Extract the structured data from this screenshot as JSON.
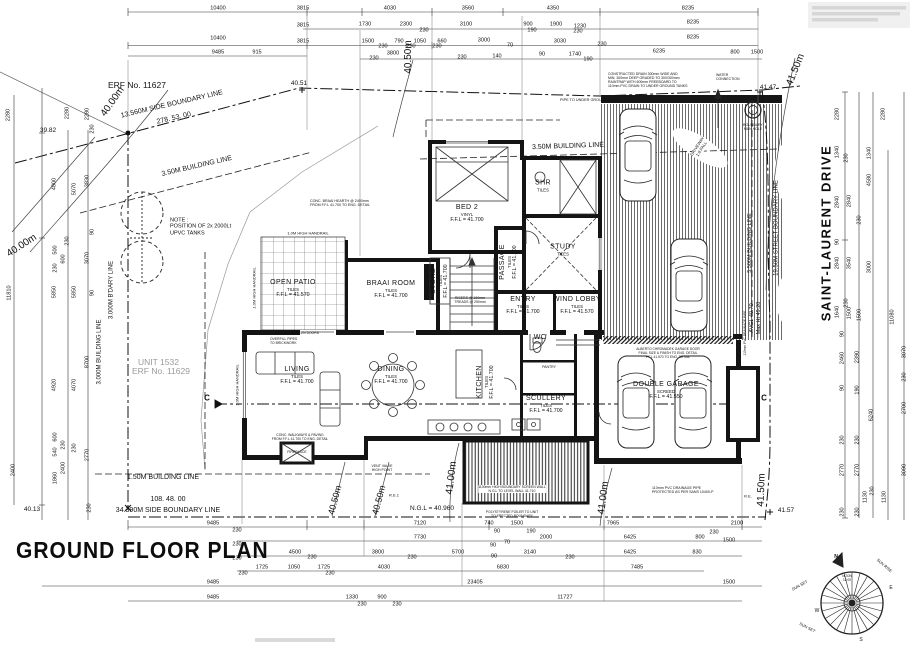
{
  "title": "GROUND FLOOR PLAN",
  "site": {
    "erf_label": "ERF No. 11627",
    "unit_label": "UNIT 1532",
    "unit_erf_label": "ERF No. 11629",
    "street_name": "SAINT-LAURENT DRIVE"
  },
  "rooms": [
    {
      "name": "OPEN PATIO",
      "finish": "TILES",
      "ffl": "F.F.L = 41.570",
      "x": 293,
      "y": 289
    },
    {
      "name": "BRAAI ROOM",
      "finish": "TILES",
      "ffl": "F.F.L = 41.700",
      "x": 391,
      "y": 290
    },
    {
      "name": "BED 2",
      "finish": "VINYL",
      "ffl": "F.F.L = 41.700",
      "x": 467,
      "y": 214
    },
    {
      "name": "SHR",
      "finish": "TILES",
      "ffl": "",
      "x": 543,
      "y": 186
    },
    {
      "name": "STUDY",
      "finish": "TILES",
      "ffl": "",
      "x": 563,
      "y": 250
    },
    {
      "name": "PASSAGE",
      "finish": "TILES",
      "ffl": "F.F.L = 41.700",
      "x": 509,
      "y": 262,
      "r": -90
    },
    {
      "name": "STORE",
      "finish": "TILES",
      "ffl": "F.F.L = 41.700",
      "x": 440,
      "y": 281,
      "r": -90
    },
    {
      "name": "ENTRY",
      "finish": "TILES",
      "ffl": "F.F.L = 41.700",
      "x": 523,
      "y": 306
    },
    {
      "name": "WIND LOBBY",
      "finish": "TILES",
      "ffl": "F.F.L = 41.570",
      "x": 577,
      "y": 306
    },
    {
      "name": "LIVING",
      "finish": "TILES",
      "ffl": "F.F.L = 41.700",
      "x": 297,
      "y": 376
    },
    {
      "name": "DINING",
      "finish": "TILES",
      "ffl": "F.F.L = 41.700",
      "x": 391,
      "y": 376
    },
    {
      "name": "KITCHEN",
      "finish": "TILES",
      "ffl": "F.F.L = 41.700",
      "x": 486,
      "y": 382,
      "r": -90
    },
    {
      "name": "SCULLERY",
      "finish": "TILES",
      "ffl": "F.F.L = 41.700",
      "x": 546,
      "y": 405
    },
    {
      "name": "WC",
      "finish": "",
      "ffl": "",
      "x": 540,
      "y": 338
    },
    {
      "name": "DOUBLE GARAGE",
      "finish": "SCREED",
      "ffl": "F.F.L = 41.550",
      "x": 666,
      "y": 391
    }
  ],
  "boundary_labels": [
    {
      "t": "13.560M SIDE BOUNDARY LINE",
      "x": 172,
      "y": 105,
      "r": -13,
      "size": 7,
      "n": "side-boundary-label"
    },
    {
      "t": "278.  53.  00",
      "x": 174,
      "y": 119,
      "r": -13,
      "size": 7,
      "n": "bearing-label"
    },
    {
      "t": "3.50M BUILDING LINE",
      "x": 197,
      "y": 167,
      "r": -13,
      "size": 7,
      "n": "building-line-label"
    },
    {
      "t": "3.50M BUILDING LINE",
      "x": 568,
      "y": 147,
      "r": -2,
      "size": 7,
      "n": "building-line-label"
    },
    {
      "t": "1.50M BUILDING LINE",
      "x": 163,
      "y": 478,
      "r": 0,
      "size": 7,
      "n": "building-line-label"
    },
    {
      "t": "108.  48.  00",
      "x": 168,
      "y": 500,
      "r": 0,
      "size": 7,
      "n": "bearing-label"
    },
    {
      "t": "34.390M SIDE BOUNDARY LINE",
      "x": 168,
      "y": 511,
      "r": 0,
      "size": 7,
      "n": "side-boundary-label"
    },
    {
      "t": "19.50M STREET BOUNDARY LINE",
      "x": 777,
      "y": 228,
      "r": -90,
      "size": 6,
      "n": "street-boundary-label"
    },
    {
      "t": "5.500M BUILDING LINE",
      "x": 750,
      "y": 243,
      "r": -90,
      "size": 5.5,
      "n": "building-line-label"
    },
    {
      "t": "3.000M B'DARY LINE",
      "x": 112,
      "y": 290,
      "r": -90,
      "size": 6,
      "n": "boundary-label"
    },
    {
      "t": "3.000M BUILDING LINE",
      "x": 100,
      "y": 352,
      "r": -90,
      "size": 6,
      "n": "building-line-label"
    },
    {
      "t": "C",
      "x": 207,
      "y": 398,
      "r": 0,
      "size": 8,
      "bold": true,
      "n": "section-marker"
    },
    {
      "t": "C",
      "x": 764,
      "y": 398,
      "r": 0,
      "size": 8,
      "bold": true,
      "n": "section-marker"
    }
  ],
  "levels": [
    {
      "t": "40.00m",
      "x": 113,
      "y": 102,
      "r": -55,
      "size": 10
    },
    {
      "t": "40.00m",
      "x": 22,
      "y": 246,
      "r": -33,
      "size": 10
    },
    {
      "t": "40.50m",
      "x": 409,
      "y": 57,
      "r": -90,
      "size": 10
    },
    {
      "t": "40.50m",
      "x": 335,
      "y": 500,
      "r": -75,
      "size": 9
    },
    {
      "t": "40.50m",
      "x": 379,
      "y": 500,
      "r": -75,
      "size": 9
    },
    {
      "t": "41.00m",
      "x": 452,
      "y": 478,
      "r": -83,
      "size": 10
    },
    {
      "t": "41.00m",
      "x": 604,
      "y": 498,
      "r": -83,
      "size": 10
    },
    {
      "t": "41.50m",
      "x": 796,
      "y": 70,
      "r": -68,
      "size": 10
    },
    {
      "t": "41.50m",
      "x": 762,
      "y": 490,
      "r": -88,
      "size": 10
    },
    {
      "t": "39.82",
      "x": 48,
      "y": 131,
      "size": 6.5
    },
    {
      "t": "40.51",
      "x": 299,
      "y": 84,
      "size": 6.5
    },
    {
      "t": "41.47",
      "x": 768,
      "y": 88,
      "size": 6.5
    },
    {
      "t": "41.57",
      "x": 786,
      "y": 511,
      "size": 6.5
    },
    {
      "t": "40.13",
      "x": 32,
      "y": 510,
      "size": 6.5
    },
    {
      "t": "N.G.L = 40.960",
      "x": 432,
      "y": 509,
      "size": 6.5
    },
    {
      "t": "AVGL 40.70",
      "x": 752,
      "y": 318,
      "r": -90,
      "size": 5.5
    },
    {
      "t": "Max Ht 49.20",
      "x": 759,
      "y": 318,
      "r": -90,
      "size": 5.5
    }
  ],
  "dims_top": [
    [
      "10400",
      218,
      9
    ],
    [
      "3815",
      303,
      9
    ],
    [
      "4030",
      390,
      9
    ],
    [
      "3560",
      468,
      9
    ],
    [
      "4350",
      553,
      9
    ],
    [
      "8235",
      688,
      9
    ],
    [
      "3815",
      303,
      26
    ],
    [
      "1730",
      365,
      25
    ],
    [
      "2300",
      406,
      25
    ],
    [
      "230",
      424,
      31
    ],
    [
      "3100",
      466,
      25
    ],
    [
      "900",
      528,
      25
    ],
    [
      "1900",
      556,
      25
    ],
    [
      "1230",
      580,
      27
    ],
    [
      "190",
      532,
      31
    ],
    [
      "230",
      578,
      32
    ],
    [
      "8235",
      693,
      23
    ],
    [
      "10400",
      218,
      39
    ],
    [
      "3815",
      303,
      42
    ],
    [
      "1500",
      368,
      42
    ],
    [
      "790",
      399,
      42
    ],
    [
      "1050",
      420,
      42
    ],
    [
      "660",
      442,
      42
    ],
    [
      "230",
      383,
      47
    ],
    [
      "230",
      411,
      47
    ],
    [
      "230",
      437,
      47
    ],
    [
      "3000",
      484,
      41
    ],
    [
      "70",
      510,
      46
    ],
    [
      "3030",
      560,
      42
    ],
    [
      "230",
      602,
      45
    ],
    [
      "8235",
      693,
      38
    ],
    [
      "9485",
      218,
      53
    ],
    [
      "915",
      257,
      53
    ],
    [
      "3800",
      393,
      54
    ],
    [
      "230",
      374,
      59
    ],
    [
      "140",
      497,
      57
    ],
    [
      "90",
      542,
      55
    ],
    [
      "1740",
      575,
      55
    ],
    [
      "190",
      588,
      60
    ],
    [
      "230",
      462,
      58
    ],
    [
      "6235",
      659,
      52
    ],
    [
      "800",
      735,
      53
    ],
    [
      "1500",
      757,
      53
    ]
  ],
  "dims_left": [
    [
      "2280",
      9,
      115
    ],
    [
      "2280",
      68,
      113
    ],
    [
      "2280",
      88,
      114
    ],
    [
      "230",
      93,
      129
    ],
    [
      "4800",
      55,
      184
    ],
    [
      "5070",
      75,
      189
    ],
    [
      "3830",
      88,
      181
    ],
    [
      "90",
      93,
      232
    ],
    [
      "500",
      56,
      250
    ],
    [
      "230",
      68,
      241
    ],
    [
      "600",
      64,
      259
    ],
    [
      "3070",
      88,
      258
    ],
    [
      "230",
      56,
      268
    ],
    [
      "5850",
      55,
      292
    ],
    [
      "5850",
      75,
      292
    ],
    [
      "90",
      93,
      293
    ],
    [
      "11810",
      10,
      293
    ],
    [
      "8700",
      88,
      362
    ],
    [
      "4920",
      55,
      385
    ],
    [
      "4070",
      75,
      385
    ],
    [
      "600",
      56,
      437
    ],
    [
      "230",
      64,
      445
    ],
    [
      "540",
      56,
      452
    ],
    [
      "230",
      75,
      448
    ],
    [
      "2770",
      88,
      455
    ],
    [
      "2400",
      64,
      468
    ],
    [
      "1860",
      56,
      478
    ],
    [
      "2400",
      14,
      470
    ],
    [
      "230",
      90,
      508
    ]
  ],
  "dims_right": [
    [
      "2280",
      838,
      114
    ],
    [
      "2280",
      884,
      114
    ],
    [
      "1340",
      838,
      152
    ],
    [
      "1340",
      870,
      153
    ],
    [
      "230",
      847,
      158
    ],
    [
      "4580",
      870,
      180
    ],
    [
      "2840",
      838,
      202
    ],
    [
      "2840",
      850,
      201
    ],
    [
      "230",
      860,
      220
    ],
    [
      "90",
      838,
      242
    ],
    [
      "2840",
      838,
      263
    ],
    [
      "3540",
      850,
      263
    ],
    [
      "3000",
      870,
      267
    ],
    [
      "230",
      847,
      303
    ],
    [
      "1640",
      838,
      312
    ],
    [
      "1500",
      850,
      313
    ],
    [
      "1500",
      860,
      315
    ],
    [
      "11080",
      893,
      317
    ],
    [
      "90",
      843,
      334
    ],
    [
      "2460",
      843,
      358
    ],
    [
      "2390",
      858,
      357
    ],
    [
      "3070",
      905,
      352
    ],
    [
      "230",
      905,
      377
    ],
    [
      "190",
      858,
      390
    ],
    [
      "90",
      843,
      388
    ],
    [
      "6240",
      872,
      415
    ],
    [
      "2700",
      905,
      408
    ],
    [
      "230",
      843,
      440
    ],
    [
      "230",
      858,
      440
    ],
    [
      "2770",
      843,
      470
    ],
    [
      "2770",
      858,
      470
    ],
    [
      "3090",
      905,
      470
    ],
    [
      "1130",
      866,
      497
    ],
    [
      "230",
      873,
      491
    ],
    [
      "1130",
      885,
      497
    ],
    [
      "230",
      843,
      512
    ],
    [
      "230",
      858,
      512
    ]
  ],
  "dims_bottom": [
    [
      "9485",
      213,
      524
    ],
    [
      "7120",
      420,
      524
    ],
    [
      "740",
      489,
      524
    ],
    [
      "1500",
      517,
      524
    ],
    [
      "7965",
      613,
      524
    ],
    [
      "2100",
      737,
      524
    ],
    [
      "230",
      237,
      531
    ],
    [
      "7730",
      420,
      538
    ],
    [
      "90",
      497,
      532
    ],
    [
      "190",
      531,
      532
    ],
    [
      "2000",
      546,
      538
    ],
    [
      "70",
      507,
      543
    ],
    [
      "90",
      493,
      546
    ],
    [
      "6425",
      630,
      538
    ],
    [
      "800",
      700,
      538
    ],
    [
      "1500",
      729,
      541
    ],
    [
      "230",
      714,
      533
    ],
    [
      "230",
      237,
      545
    ],
    [
      "4500",
      295,
      553
    ],
    [
      "230",
      312,
      558
    ],
    [
      "3800",
      378,
      553
    ],
    [
      "230",
      412,
      558
    ],
    [
      "5700",
      458,
      553
    ],
    [
      "90",
      494,
      557
    ],
    [
      "3140",
      530,
      553
    ],
    [
      "230",
      570,
      558
    ],
    [
      "6425",
      630,
      553
    ],
    [
      "830",
      697,
      553
    ],
    [
      "230",
      237,
      559
    ],
    [
      "1725",
      262,
      568
    ],
    [
      "1050",
      294,
      568
    ],
    [
      "1725",
      324,
      568
    ],
    [
      "4030",
      384,
      568
    ],
    [
      "6830",
      503,
      568
    ],
    [
      "7485",
      637,
      568
    ],
    [
      "230",
      243,
      574
    ],
    [
      "230",
      330,
      574
    ],
    [
      "9485",
      213,
      583
    ],
    [
      "23405",
      475,
      583
    ],
    [
      "1500",
      729,
      583
    ],
    [
      "9485",
      213,
      598
    ],
    [
      "1330",
      352,
      598
    ],
    [
      "900",
      382,
      598
    ],
    [
      "230",
      362,
      605
    ],
    [
      "230",
      397,
      605
    ],
    [
      "11727",
      565,
      598
    ]
  ],
  "notes": [
    {
      "lines": [
        "NOTE :",
        "POSITION OF 2x 2000Lt",
        "UPVC TANKS"
      ],
      "x": 170,
      "y": 227,
      "size": 5.5,
      "align": "left"
    },
    {
      "lines": [
        "CONSTRUCTED DRAIN 300mm WIDE AND",
        "MIN. 300mm DEEP GRADED TO 300/300mm",
        "RAINTRAP WITH 600mm FREEBOARD TO",
        "110mm PVC DRAIN TO UNDER GROUND TANKS"
      ],
      "x": 608,
      "y": 80,
      "size": 3.5,
      "align": "left"
    },
    {
      "lines": [
        "WATER",
        "CONNECTION"
      ],
      "x": 716,
      "y": 77,
      "size": 3.5,
      "align": "left"
    },
    {
      "lines": [
        "BOUNDARY",
        "MAN HOLE"
      ],
      "x": 753,
      "y": 127,
      "size": 3.5
    },
    {
      "lines": [
        "PIPE TO UNDER GROUND TANKS"
      ],
      "x": 560,
      "y": 100,
      "size": 3.8,
      "align": "left"
    },
    {
      "lines": [
        "CONC. BRAAI HEARTH @ 2400mm",
        "FROM F.F.L 41.700 TO ENG. DETAIL"
      ],
      "x": 310,
      "y": 203,
      "size": 3.6,
      "align": "left"
    },
    {
      "lines": [
        "1.0M HIGH HANDRAIL"
      ],
      "x": 308,
      "y": 234,
      "size": 4
    },
    {
      "lines": [
        "1.0M HIGH HANDRAIL"
      ],
      "x": 255,
      "y": 288,
      "r": -90,
      "size": 4
    },
    {
      "lines": [
        "1.0M HIGH HANDRAIL"
      ],
      "x": 238,
      "y": 385,
      "r": -90,
      "size": 4
    },
    {
      "lines": [
        "RISERS @ 169mm",
        "TREADS @ 250mm"
      ],
      "x": 470,
      "y": 300,
      "size": 3.5
    },
    {
      "lines": [
        "110mm PVC DRAINAGE PIPE",
        "PROTECTED AS PER SANS 10400-P"
      ],
      "x": 652,
      "y": 490,
      "size": 3.6,
      "align": "left"
    },
    {
      "lines": [
        "DRIVEWAY",
        "1:8 FALL"
      ],
      "x": 700,
      "y": 148,
      "r": -57,
      "size": 4.2,
      "bg": true
    },
    {
      "lines": [
        "VENT VALVE",
        "HIGH POINT"
      ],
      "x": 382,
      "y": 468,
      "size": 3.5
    },
    {
      "lines": [
        "R.E.1"
      ],
      "x": 394,
      "y": 496,
      "size": 4
    },
    {
      "lines": [
        "R.E."
      ],
      "x": 748,
      "y": 497,
      "size": 4
    },
    {
      "lines": [
        "ALBERTO CHROMADEK GARAGE DOOR",
        "FINAL SIZE & FINISH TO ENG. DETAIL",
        "F.F.L 41.570 TO ENG. DETAIL"
      ],
      "x": 668,
      "y": 354,
      "size": 3.3
    },
    {
      "lines": [
        "110mm PVC DRAINAGE PIPE"
      ],
      "x": 746,
      "y": 333,
      "r": -90,
      "size": 3.3
    },
    {
      "lines": [
        "1100mm HIGH BOUNDARY SCREEN WALL",
        "N.G.L TO LEVEL WALL 41.710"
      ],
      "x": 512,
      "y": 489,
      "size": 3.4,
      "bg": true
    },
    {
      "lines": [
        "FIREPLACE"
      ],
      "x": 297,
      "y": 452,
      "size": 3.5
    },
    {
      "lines": [
        "PANTRY"
      ],
      "x": 549,
      "y": 367,
      "size": 3.5
    },
    {
      "lines": [
        "OVERFILL PIPES",
        "TO BRICKWORK"
      ],
      "x": 270,
      "y": 341,
      "size": 3.4,
      "align": "left"
    },
    {
      "lines": [
        "SLIDING SCREEN DOORS"
      ],
      "x": 298,
      "y": 333,
      "size": 3.4
    },
    {
      "lines": [
        "CONC. WALKWAYS & PAVING",
        "FROM F.F.L 41.700 TO ENG. DETAIL"
      ],
      "x": 300,
      "y": 437,
      "size": 3.4
    },
    {
      "lines": [
        "POLYSTYRENE FOILER TO UNIT",
        "TO ERECTED BOUNDARY"
      ],
      "x": 512,
      "y": 514,
      "size": 3.4
    }
  ],
  "compass": {
    "labels": [
      {
        "t": "N",
        "x": 836,
        "y": 558,
        "size": 5,
        "bold": true
      },
      {
        "t": "SUN RISE",
        "x": 884,
        "y": 566,
        "r": 40,
        "size": 4
      },
      {
        "t": "E",
        "x": 891,
        "y": 589,
        "size": 5
      },
      {
        "t": "SUN SET",
        "x": 800,
        "y": 586,
        "r": -30,
        "size": 4
      },
      {
        "t": "W",
        "x": 817,
        "y": 612,
        "size": 5
      },
      {
        "t": "SUN SET",
        "x": 807,
        "y": 628,
        "r": 28,
        "size": 4
      },
      {
        "t": "S",
        "x": 861,
        "y": 641,
        "size": 5
      },
      {
        "t": "NOON",
        "x": 847,
        "y": 577,
        "size": 3.2
      },
      {
        "t": "12:00",
        "x": 847,
        "y": 581,
        "size": 3.2
      }
    ]
  }
}
